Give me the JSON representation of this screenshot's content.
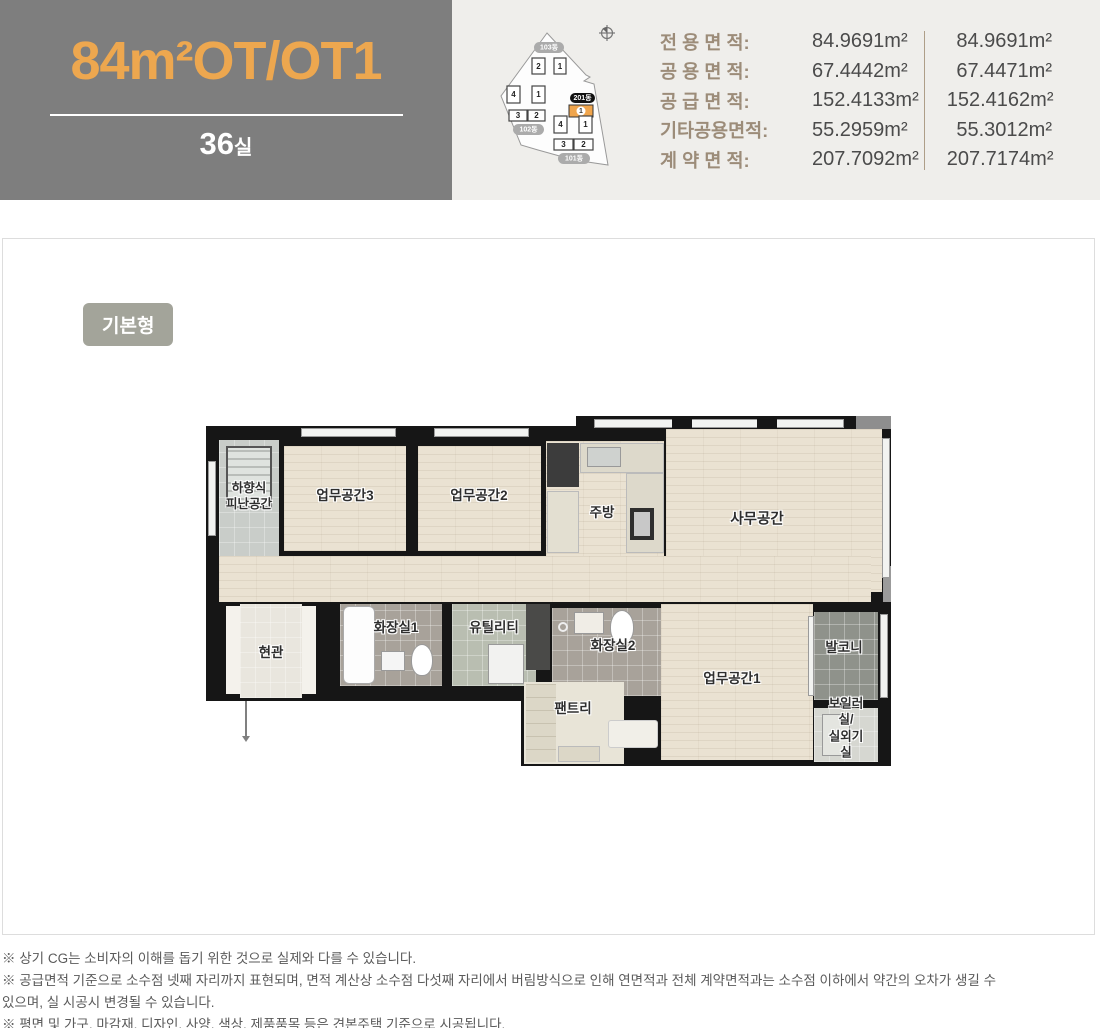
{
  "header": {
    "unit_title": "84m²OT/OT1",
    "room_count": "36",
    "room_count_suffix": "실"
  },
  "site_map": {
    "buildings": [
      {
        "name": "103동",
        "units": [
          "2",
          "1"
        ]
      },
      {
        "name": "102동",
        "units": [
          "4",
          "1",
          "3",
          "2"
        ]
      },
      {
        "name": "201동",
        "units": [
          "1"
        ],
        "highlighted": true
      },
      {
        "name": "101동",
        "units": [
          "4",
          "1",
          "3",
          "2"
        ]
      }
    ]
  },
  "area_table": {
    "rows": [
      {
        "label": "전 용 면 적:",
        "value1": "84.9691m²",
        "value2": "84.9691m²"
      },
      {
        "label": "공 용 면 적:",
        "value1": "67.4442m²",
        "value2": "67.4471m²"
      },
      {
        "label": "공 급 면 적:",
        "value1": "152.4133m²",
        "value2": "152.4162m²"
      },
      {
        "label": "기타공용면적:",
        "value1": "55.2959m²",
        "value2": "55.3012m²"
      },
      {
        "label": "계 약 면 적:",
        "value1": "207.7092m²",
        "value2": "207.7174m²"
      }
    ]
  },
  "plan": {
    "type_badge": "기본형",
    "rooms": {
      "escape": "하향식\n피난공간",
      "work3": "업무공간3",
      "work2": "업무공간2",
      "kitchen": "주방",
      "office": "사무공간",
      "entrance": "현관",
      "bath1": "화장실1",
      "utility": "유틸리티",
      "bath2": "화장실2",
      "pantry": "팬트리",
      "work1": "업무공간1",
      "balcony": "발코니",
      "boiler": "보일러실/\n실외기실"
    }
  },
  "footnotes": [
    "※ 상기 CG는 소비자의 이해를 돕기 위한 것으로 실제와 다를 수 있습니다.",
    "※ 공급면적 기준으로 소수점 넷째 자리까지 표현되며, 면적 계산상 소수점 다섯째 자리에서 버림방식으로 인해 연면적과 전체 계약면적과는 소수점 이하에서 약간의 오차가 생길 수 있으며, 실 시공시 변경될 수 있습니다.",
    "※ 평면 및 가구, 마감재, 디자인, 사양, 색상, 제품품목 등은 견본주택 기준으로 시공됩니다."
  ],
  "colors": {
    "accent_orange": "#EDA74F",
    "header_gray": "#7E7E7E",
    "header_panel_bg": "#EFEEEB",
    "badge_bg": "#A3A49A",
    "highlight_orange": "#F0A54C"
  }
}
